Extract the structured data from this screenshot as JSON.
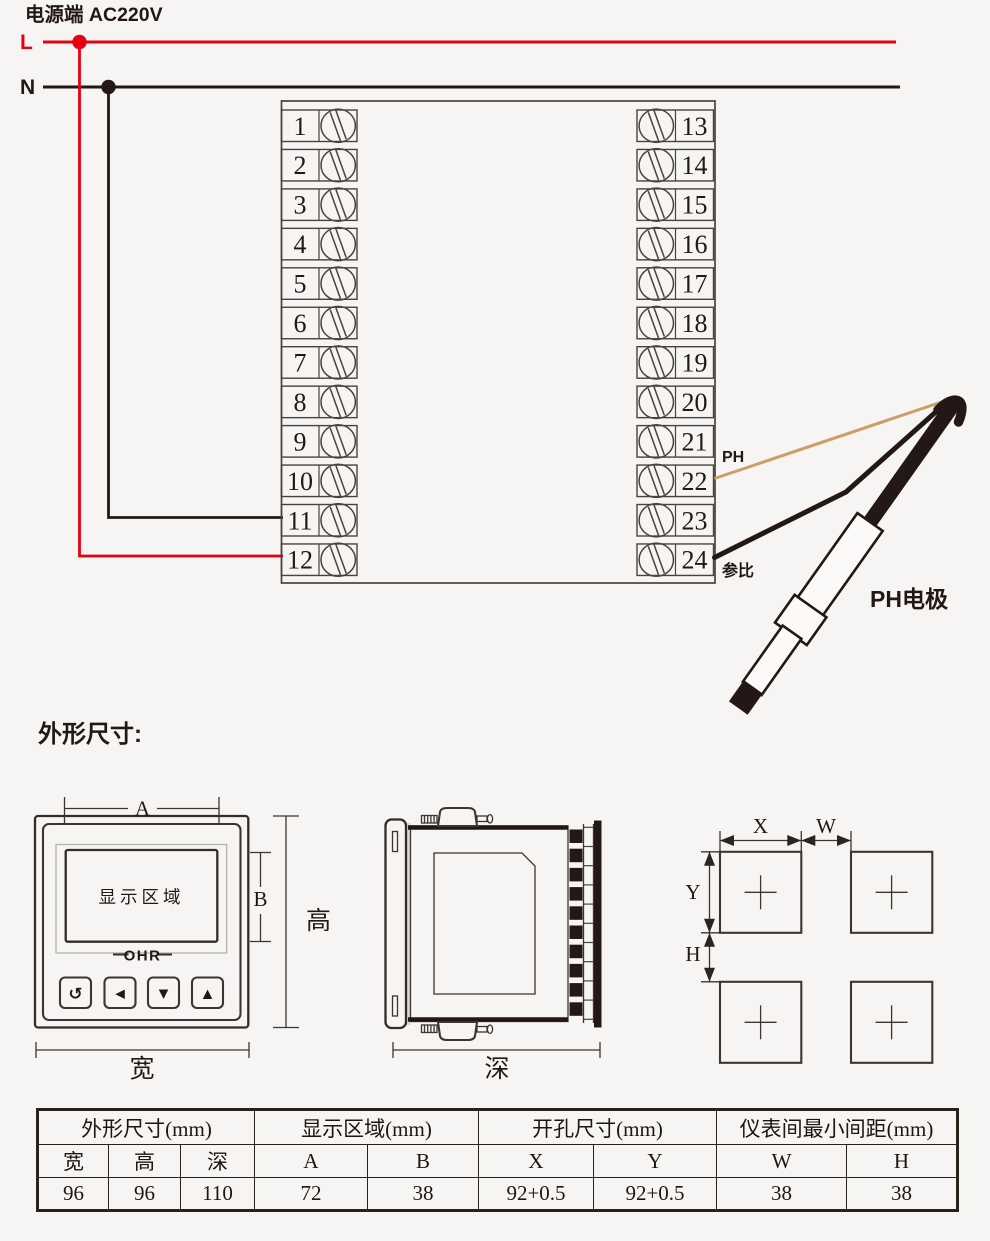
{
  "wiring": {
    "power_label": "电源端  AC220V",
    "live_label": "L",
    "neutral_label": "N",
    "terminals_left": [
      "1",
      "2",
      "3",
      "4",
      "5",
      "6",
      "7",
      "8",
      "9",
      "10",
      "11",
      "12"
    ],
    "terminals_right": [
      "13",
      "14",
      "15",
      "16",
      "17",
      "18",
      "19",
      "20",
      "21",
      "22",
      "23",
      "24"
    ],
    "ph_wire_label": "PH",
    "reference_wire_label": "参比",
    "electrode_label": "PH电极",
    "colors": {
      "live_wire": "#e60012",
      "neutral_wire": "#231815",
      "ph_wire": "#c9a066"
    }
  },
  "dimensions": {
    "heading": "外形尺寸:",
    "front_view": {
      "display_area_label": "显示区域",
      "brand": "OHR",
      "buttons": [
        "↺",
        "◀",
        "▼",
        "▲"
      ],
      "dim_a": "A",
      "dim_b": "B",
      "dim_height": "高",
      "dim_width": "宽"
    },
    "side_view": {
      "dim_depth": "深"
    },
    "cutout_view": {
      "dim_x": "X",
      "dim_w": "W",
      "dim_y": "Y",
      "dim_h": "H"
    }
  },
  "spec_table": {
    "groups": [
      {
        "label": "外形尺寸(mm)",
        "span": 3
      },
      {
        "label": "显示区域(mm)",
        "span": 2
      },
      {
        "label": "开孔尺寸(mm)",
        "span": 2
      },
      {
        "label": "仪表间最小间距(mm)",
        "span": 2
      }
    ],
    "columns": [
      "宽",
      "高",
      "深",
      "A",
      "B",
      "X",
      "Y",
      "W",
      "H"
    ],
    "values": [
      "96",
      "96",
      "110",
      "72",
      "38",
      "92+0.5",
      "92+0.5",
      "38",
      "38"
    ]
  }
}
